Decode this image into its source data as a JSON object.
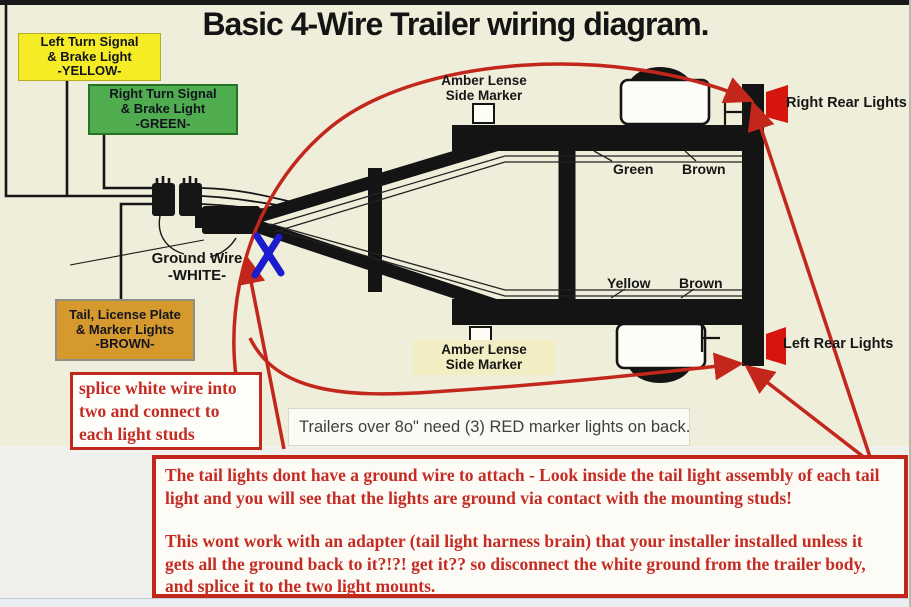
{
  "page": {
    "title": "Basic 4-Wire Trailer wiring diagram."
  },
  "callouts": {
    "left_turn": {
      "line1": "Left Turn Signal",
      "line2": "& Brake Light",
      "line3": "-YELLOW-"
    },
    "right_turn": {
      "line1": "Right Turn Signal",
      "line2": "& Brake Light",
      "line3": "-GREEN-"
    },
    "tail": {
      "line1": "Tail, License Plate",
      "line2": "& Marker Lights",
      "line3": "-BROWN-"
    }
  },
  "labels": {
    "amber_top": {
      "line1": "Amber Lense",
      "line2": "Side Marker"
    },
    "amber_bottom": {
      "line1": "Amber Lense",
      "line2": "Side Marker"
    },
    "ground": {
      "line1": "Ground Wire",
      "line2": "-WHITE-"
    },
    "right_rear": "Right Rear Lights",
    "left_rear": "Left Rear Lights",
    "wire_green_top": "Green",
    "wire_brown_top": "Brown",
    "wire_yellow_bottom": "Yellow",
    "wire_brown_bottom": "Brown"
  },
  "notes": {
    "marker_note": "Trailers over 8o\" need (3) RED marker lights on back.",
    "splice": {
      "line1": "splice white wire into",
      "line2": "two and connect to",
      "line3": "each light studs"
    },
    "ground_note_p1": "The tail lights dont have a ground wire to attach - Look inside the tail light assembly of each tail light and you will see that the lights are ground via contact with the mounting studs!",
    "ground_note_p2": "This wont work with an adapter (tail light harness brain) that your installer installed unless it gets all the ground back to it?!?! get it?? so disconnect the white ground from the trailer body, and splice it to the two light mounts."
  },
  "colors": {
    "background_cream": "#efeeda",
    "annotation_red": "#c3271c",
    "red_text": "#c42c24",
    "yellow_box": "#f5ec25",
    "green_box": "#4fad4f",
    "brown_box": "#d6992e",
    "tail_light_red": "#d6150f",
    "splice_mark_blue": "#1c1ccf",
    "frame_black": "#161616"
  }
}
